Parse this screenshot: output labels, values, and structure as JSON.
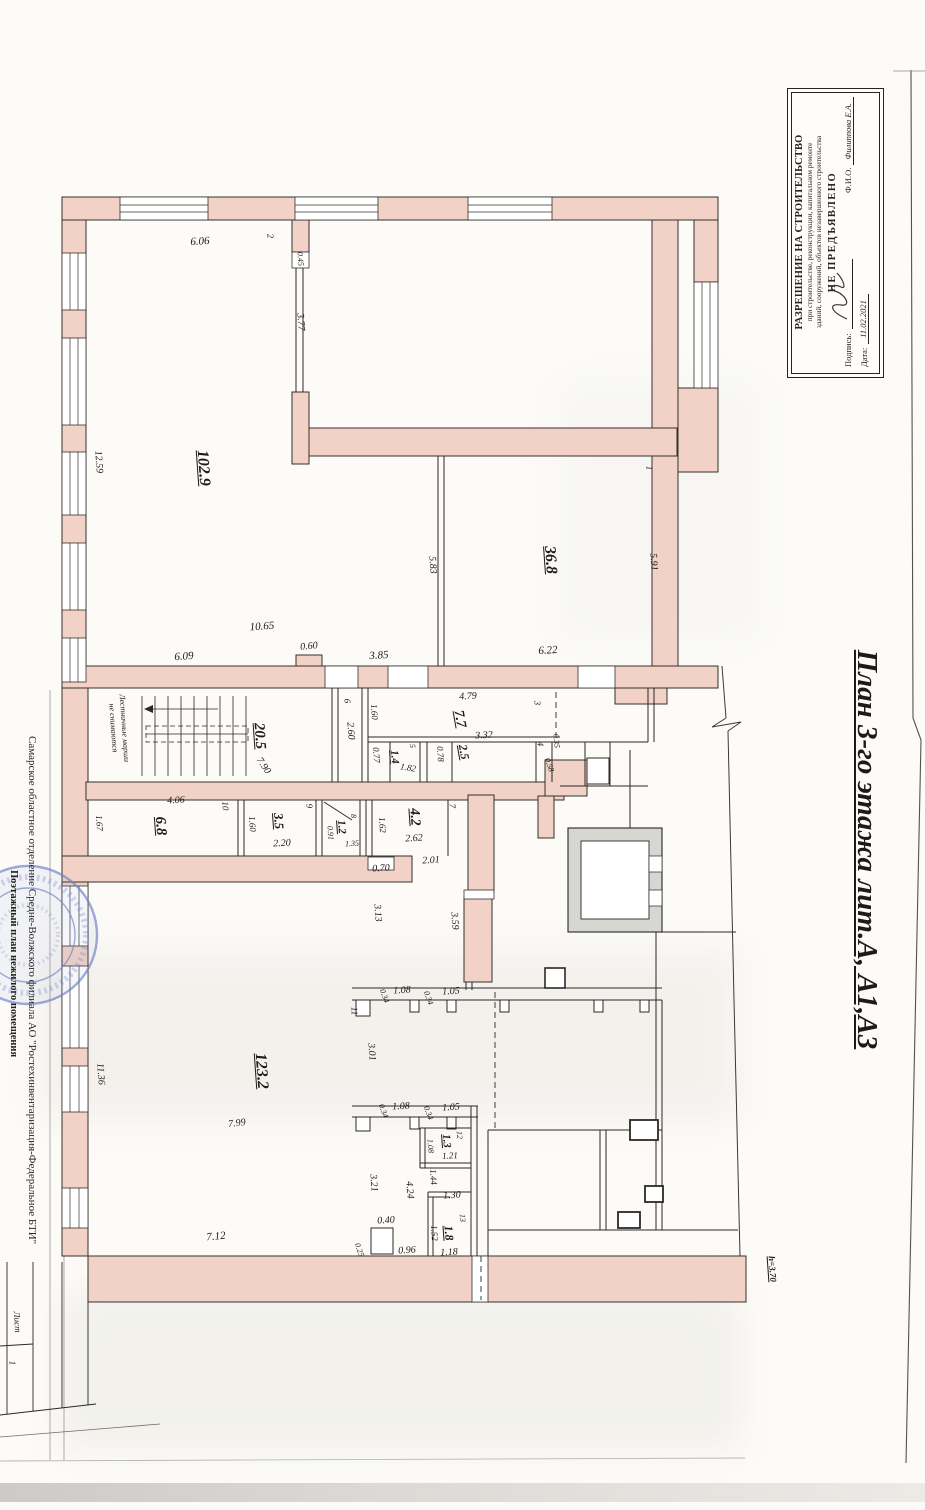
{
  "document": {
    "title_vertical": "План 3-го этажа лит.А, А1,А3"
  },
  "permit_box": {
    "line1": "РАЗРЕШЕНИЕ НА СТРОИТЕЛЬСТВО",
    "line2": "при строительстве, реконструкции, капитальном ремонте",
    "line3": "зданий, сооружений, объектов незавершенного строительства",
    "status": "НЕ ПРЕДЪЯВЛЕНО",
    "signature_label": "Подпись:",
    "fio_label": "Ф.И.О.",
    "fio_value": "Филиппова Е.А.",
    "date_label": "Дата:",
    "date_value": "11.02.2021"
  },
  "left_margin": {
    "org_line": "Самарское областное отделение Средне-Волжского филиала АО \"Ростехинвентаризация-Федеральное БТИ\"",
    "doc_line": "Поэтажный план нежилого помещения"
  },
  "colors": {
    "wall_pink": "#f2d2c6",
    "elevator_gray": "#d6d6d2",
    "stamp_blue": "#7081c9"
  },
  "rooms": [
    {
      "num": "1",
      "area": "36.8"
    },
    {
      "num": "2",
      "area": "102.9"
    },
    {
      "num": "3",
      "area": "7.7"
    },
    {
      "num": "4",
      "area": "2.5"
    },
    {
      "num": "5",
      "area": "1.4"
    },
    {
      "num": "6",
      "area": "2.60"
    },
    {
      "num": "7",
      "area": "4.2"
    },
    {
      "num": "8",
      "area": "1.2"
    },
    {
      "num": "9",
      "area": "3.5"
    },
    {
      "num": "10",
      "area": "6.8"
    },
    {
      "num": "11",
      "area": "123.2"
    },
    {
      "num": "12",
      "area": "1.3"
    },
    {
      "num": "13",
      "area": "1.8"
    },
    {
      "num": "лестница",
      "area": "20.5"
    }
  ],
  "plan_labels": [
    {
      "t": "6.06",
      "x": 200,
      "y": 242,
      "r": -4,
      "s": 11
    },
    {
      "t": "2",
      "x": 270,
      "y": 236,
      "r": 86,
      "s": 9
    },
    {
      "t": "0.45",
      "x": 300,
      "y": 259,
      "r": 86,
      "s": 8
    },
    {
      "t": "3.77",
      "x": 300,
      "y": 322,
      "r": 86,
      "s": 10
    },
    {
      "t": "12.59",
      "x": 98,
      "y": 462,
      "r": 86,
      "s": 10
    },
    {
      "t": "102.9",
      "x": 203,
      "y": 468,
      "r": 86,
      "s": 16,
      "u": 1
    },
    {
      "t": "1",
      "x": 649,
      "y": 468,
      "r": 86,
      "s": 9
    },
    {
      "t": "5.91",
      "x": 653,
      "y": 562,
      "r": 86,
      "s": 10
    },
    {
      "t": "36.8",
      "x": 550,
      "y": 560,
      "r": 86,
      "s": 16,
      "u": 1
    },
    {
      "t": "5.83",
      "x": 432,
      "y": 565,
      "r": 86,
      "s": 10
    },
    {
      "t": "10.65",
      "x": 262,
      "y": 627,
      "r": -4,
      "s": 11
    },
    {
      "t": "6.09",
      "x": 184,
      "y": 657,
      "r": -4,
      "s": 11
    },
    {
      "t": "0.60",
      "x": 309,
      "y": 647,
      "r": -6,
      "s": 10
    },
    {
      "t": "3.85",
      "x": 379,
      "y": 656,
      "r": -4,
      "s": 11
    },
    {
      "t": "6.22",
      "x": 548,
      "y": 651,
      "r": -4,
      "s": 11
    },
    {
      "t": "4.79",
      "x": 468,
      "y": 697,
      "r": -3,
      "s": 10
    },
    {
      "t": "7.7",
      "x": 459,
      "y": 719,
      "r": 80,
      "s": 14,
      "u": 1
    },
    {
      "t": "3",
      "x": 537,
      "y": 703,
      "r": 86,
      "s": 9
    },
    {
      "t": "6",
      "x": 347,
      "y": 701,
      "r": 86,
      "s": 9
    },
    {
      "t": "1.60",
      "x": 374,
      "y": 712,
      "r": 86,
      "s": 9
    },
    {
      "t": "2.60",
      "x": 350,
      "y": 731,
      "r": 86,
      "s": 10
    },
    {
      "t": "0.77",
      "x": 376,
      "y": 755,
      "r": 86,
      "s": 9
    },
    {
      "t": "1.4",
      "x": 394,
      "y": 757,
      "r": 86,
      "s": 11,
      "u": 1
    },
    {
      "t": "1.82",
      "x": 408,
      "y": 768,
      "r": 10,
      "s": 9
    },
    {
      "t": "5",
      "x": 412,
      "y": 746,
      "r": 86,
      "s": 8
    },
    {
      "t": "0.78",
      "x": 440,
      "y": 754,
      "r": 86,
      "s": 9
    },
    {
      "t": "3.32",
      "x": 484,
      "y": 736,
      "r": -3,
      "s": 10
    },
    {
      "t": "2.5",
      "x": 464,
      "y": 752,
      "r": 80,
      "s": 12,
      "u": 1
    },
    {
      "t": "4",
      "x": 540,
      "y": 744,
      "r": 86,
      "s": 9
    },
    {
      "t": "0.35",
      "x": 556,
      "y": 741,
      "r": 86,
      "s": 8
    },
    {
      "t": "0.58",
      "x": 549,
      "y": 765,
      "r": 70,
      "s": 8
    },
    {
      "t": "Лестничные марши",
      "x": 124,
      "y": 728,
      "r": 86,
      "s": 8
    },
    {
      "t": "не снимаются",
      "x": 113,
      "y": 728,
      "r": 86,
      "s": 8
    },
    {
      "t": "20.5",
      "x": 259,
      "y": 736,
      "r": 86,
      "s": 15,
      "u": 1
    },
    {
      "t": "7.90",
      "x": 263,
      "y": 766,
      "r": 55,
      "s": 10
    },
    {
      "t": "4.06",
      "x": 176,
      "y": 801,
      "r": -3,
      "s": 10
    },
    {
      "t": "10",
      "x": 225,
      "y": 806,
      "r": 86,
      "s": 9
    },
    {
      "t": "1.67",
      "x": 99,
      "y": 823,
      "r": 86,
      "s": 9
    },
    {
      "t": "6.8",
      "x": 160,
      "y": 826,
      "r": 86,
      "s": 15,
      "u": 1
    },
    {
      "t": "9",
      "x": 309,
      "y": 806,
      "r": 86,
      "s": 9
    },
    {
      "t": "1.60",
      "x": 252,
      "y": 824,
      "r": 86,
      "s": 9
    },
    {
      "t": "3.5",
      "x": 279,
      "y": 821,
      "r": 86,
      "s": 13,
      "u": 1
    },
    {
      "t": "2.20",
      "x": 282,
      "y": 844,
      "r": -3,
      "s": 10
    },
    {
      "t": "8",
      "x": 353,
      "y": 816,
      "r": 86,
      "s": 8
    },
    {
      "t": "1.2",
      "x": 341,
      "y": 827,
      "r": 86,
      "s": 11,
      "u": 1
    },
    {
      "t": "0.91",
      "x": 330,
      "y": 833,
      "r": 86,
      "s": 8
    },
    {
      "t": "1.35",
      "x": 352,
      "y": 844,
      "r": -3,
      "s": 8
    },
    {
      "t": "1.62",
      "x": 382,
      "y": 825,
      "r": 86,
      "s": 9
    },
    {
      "t": "7",
      "x": 452,
      "y": 806,
      "r": 86,
      "s": 9
    },
    {
      "t": "4.2",
      "x": 414,
      "y": 817,
      "r": 86,
      "s": 14,
      "u": 1
    },
    {
      "t": "2.62",
      "x": 414,
      "y": 839,
      "r": -3,
      "s": 10
    },
    {
      "t": "2.01",
      "x": 431,
      "y": 861,
      "r": -3,
      "s": 10
    },
    {
      "t": "0.70",
      "x": 381,
      "y": 869,
      "r": -3,
      "s": 10
    },
    {
      "t": "3.13",
      "x": 377,
      "y": 913,
      "r": 86,
      "s": 10
    },
    {
      "t": "3.59",
      "x": 454,
      "y": 921,
      "r": 86,
      "s": 10
    },
    {
      "t": "11",
      "x": 354,
      "y": 1011,
      "r": 86,
      "s": 9
    },
    {
      "t": "0.34",
      "x": 384,
      "y": 996,
      "r": 70,
      "s": 8
    },
    {
      "t": "1.08",
      "x": 402,
      "y": 991,
      "r": -3,
      "s": 10
    },
    {
      "t": "0.34",
      "x": 428,
      "y": 998,
      "r": 70,
      "s": 8
    },
    {
      "t": "1.05",
      "x": 451,
      "y": 992,
      "r": -3,
      "s": 10
    },
    {
      "t": "3.01",
      "x": 371,
      "y": 1052,
      "r": 86,
      "s": 10
    },
    {
      "t": "123.2",
      "x": 261,
      "y": 1071,
      "r": 86,
      "s": 16,
      "u": 1
    },
    {
      "t": "7.99",
      "x": 237,
      "y": 1124,
      "r": -7,
      "s": 10
    },
    {
      "t": "11.36",
      "x": 100,
      "y": 1074,
      "r": 86,
      "s": 10
    },
    {
      "t": "0.34",
      "x": 383,
      "y": 1111,
      "r": 70,
      "s": 8
    },
    {
      "t": "1.08",
      "x": 401,
      "y": 1107,
      "r": -3,
      "s": 10
    },
    {
      "t": "0.34",
      "x": 428,
      "y": 1113,
      "r": 70,
      "s": 8
    },
    {
      "t": "1.05",
      "x": 451,
      "y": 1108,
      "r": -3,
      "s": 10
    },
    {
      "t": "12",
      "x": 459,
      "y": 1135,
      "r": 86,
      "s": 8
    },
    {
      "t": "1.3",
      "x": 446,
      "y": 1141,
      "r": 86,
      "s": 11,
      "u": 1
    },
    {
      "t": "1.08",
      "x": 430,
      "y": 1146,
      "r": 86,
      "s": 8
    },
    {
      "t": "1.21",
      "x": 450,
      "y": 1156,
      "r": -3,
      "s": 9
    },
    {
      "t": "3.21",
      "x": 373,
      "y": 1183,
      "r": 86,
      "s": 10
    },
    {
      "t": "4.24",
      "x": 409,
      "y": 1190,
      "r": 86,
      "s": 10
    },
    {
      "t": "1.44",
      "x": 433,
      "y": 1177,
      "r": 86,
      "s": 9
    },
    {
      "t": "1.30",
      "x": 452,
      "y": 1196,
      "r": -3,
      "s": 10
    },
    {
      "t": "13",
      "x": 462,
      "y": 1218,
      "r": 86,
      "s": 8
    },
    {
      "t": "1.8",
      "x": 449,
      "y": 1233,
      "r": 86,
      "s": 12,
      "u": 1
    },
    {
      "t": "1.52",
      "x": 434,
      "y": 1233,
      "r": 86,
      "s": 9
    },
    {
      "t": "1.18",
      "x": 449,
      "y": 1253,
      "r": -3,
      "s": 10
    },
    {
      "t": "0.40",
      "x": 386,
      "y": 1221,
      "r": -3,
      "s": 10
    },
    {
      "t": "0.96",
      "x": 407,
      "y": 1251,
      "r": -3,
      "s": 10
    },
    {
      "t": "0.25",
      "x": 359,
      "y": 1250,
      "r": 70,
      "s": 8
    },
    {
      "t": "7.12",
      "x": 216,
      "y": 1237,
      "r": -5,
      "s": 11
    },
    {
      "t": "h=3.70",
      "x": 772,
      "y": 1269,
      "r": 86,
      "s": 9,
      "u": 1
    },
    {
      "t": "Лист",
      "x": 17,
      "y": 1322,
      "r": 86,
      "s": 9
    },
    {
      "t": "1",
      "x": 12,
      "y": 1363,
      "r": 86,
      "s": 9
    }
  ]
}
